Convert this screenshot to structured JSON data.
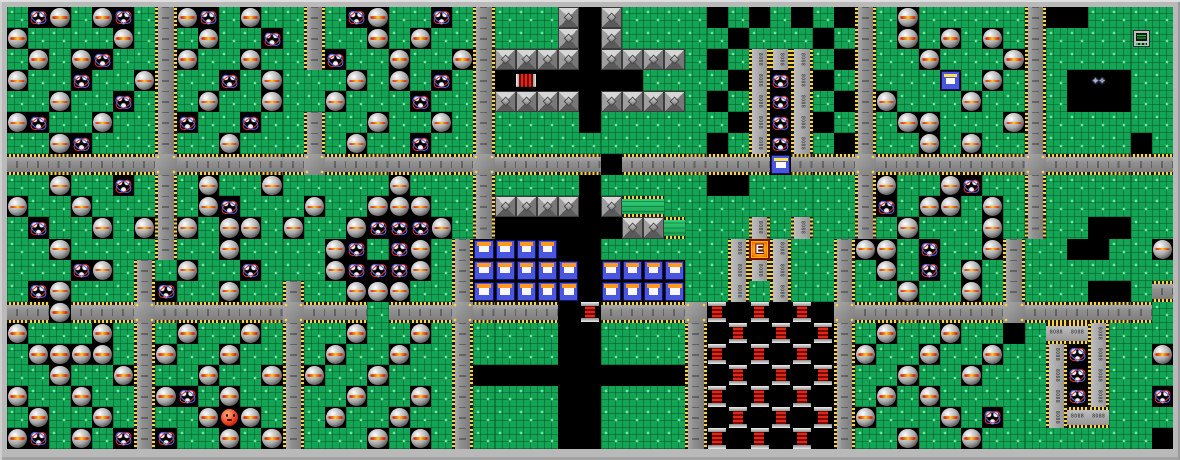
{
  "board": {
    "cols": 55,
    "rows": 21,
    "border_color": "#b9b9b9",
    "background": "#000000"
  },
  "tiles": {
    "legend": {
      ".": "base",
      " ": "space",
      "Z": "zonk",
      "I": "infotron",
      "-": "road-h",
      "|": "road-v",
      "+": "road-cross",
      "P": "wall-pyramid",
      "K": "coil",
      "c": "capacitor",
      "D": "disk-orange",
      "F": "disk-yellow",
      "E": "exit",
      "M": "murphy",
      "S": "snik-snak",
      "T": "terminal",
      "X": "electron",
      "V": "chip-v",
      "H": "chip-h",
      "G": "green-pcb"
    },
    "rows": [
      ".IZ.ZI.|ZI.Z..|.IZ..I.|...P P.... . . . |.Z.....|  ....",
      "Z....Z.|.Z..I.|..Z.Z..|...P P..... ... .|.Z.Z.Z.|....T.",
      ".Z.ZI..|Z..Z..|I..Z..Z|PPPP PPPP. .VVV. |..Z...Z|......",
      "Z..I..Z|..I.Z...Z.Z.I.| c     .... VIV .|...F.Z.|. X ..",
      "..Z..I.|.Z..Z..Z...I..|PPPP PPPP. .VIV. |Z...Z..|.   ..",
      "ZI..Z..|I..I..|..Z..Z.|....S...... VIV .|.ZZ...Z|......",
      "..ZI...|..Z...|.Z..I..|.......... .VIV. |..Z.Z..|.... .",
      "-------+------+-------+----- -------F---+-------+------",
      "..Z..I.|.Z..Z.....Z...|.... .....  .....|Z..ZI..|......",
      "Z..Z...|.ZI...Z..ZZZ..|PPPP PGG.........|I.ZZ.Z.|......",
      ".I..Z.Z|Z.ZZ.Z..ZIIIZ.|      PPG...V.V..|.Z...Z.|..  ..",
      "..Z....|..Z....ZI.IZ.|DDDD  ......VEV..|ZZ.I..Z|..  ..",
      "Z...IZ.|.Z..I...ZIIIZ.|DDDDDSDDDD..VVV..|.Z.I.Z.|......",
      "..IZ...|I..Z..|..ZZZ..|DDDDD DDDD..V.V..|..Z..Z.|...  .",
      "---Z---+------+---.---+---- K----+K K K +-------+------",
      ".Z...Z.|.Z..Z.|..Z..Z.|....  ....| K K K|.Z..Z.. .HHV..",
      "..ZZZZ.|Z..Z..|.Z..Z..|....  ....|K K K |Z..Z..Z..VIV..",
      "Z..Z..Z|..Z..Z|Z..Z...|        S | K K K|..Z..Z...VIV..",
      ".Z..Z..|ZI.Z..|..Z..Z.|....  ....|K K K |.Z.Z.....VIV..",
      "I.Z..Z.|..ZMZ.|.Z..Z..|....  ....| K K K|Z...Z.I..VHH..",
      ".ZI.Z.I|I..Z.Z|...Z.Z.|....  ....|K K K |..Z..Z........"
    ]
  },
  "sprites": {
    "exit_label": "E",
    "chip_label": "8088",
    "electron_glyph": "✦✧",
    "colors": {
      "frame": "#b9b9b9",
      "space": "#000000",
      "base": "#13a455",
      "base_light": "#6fe8a5",
      "road": "#909090",
      "chip": "#b2b2b2",
      "pin_y": "#ffd23f",
      "pin_k": "#1a1a1a",
      "sphere_hi": "#ffffff",
      "sphere": "#a8a8a8",
      "sphere_dark": "#303030",
      "stripe_red": "#d42000",
      "stripe_gold": "#ffc830",
      "orb": "#f0f0f0",
      "ring_red": "#e03030",
      "ring_blue": "#5868e8",
      "pyr_top": "#d6d6d6",
      "pyr_right": "#787878",
      "pyr_bottom": "#5a5a5a",
      "pyr_left": "#9e9e9e",
      "coil_red": "#e02818",
      "coil_dark": "#7a0a00",
      "disk_blue": "#4a55e0",
      "disk_label": "#f8f8f8",
      "label_orange": "#ff9820",
      "label_yellow": "#ffe24a",
      "exit_o1": "#ffd34a",
      "exit_o2": "#ff7a00",
      "exit_o3": "#c22800",
      "murphy": "#e84020",
      "term_body": "#c0c0c0",
      "term_screen": "#00240a",
      "term_green": "#20c040",
      "electron": "#9fb0ff",
      "pcb_green": "#2ecc71"
    }
  }
}
